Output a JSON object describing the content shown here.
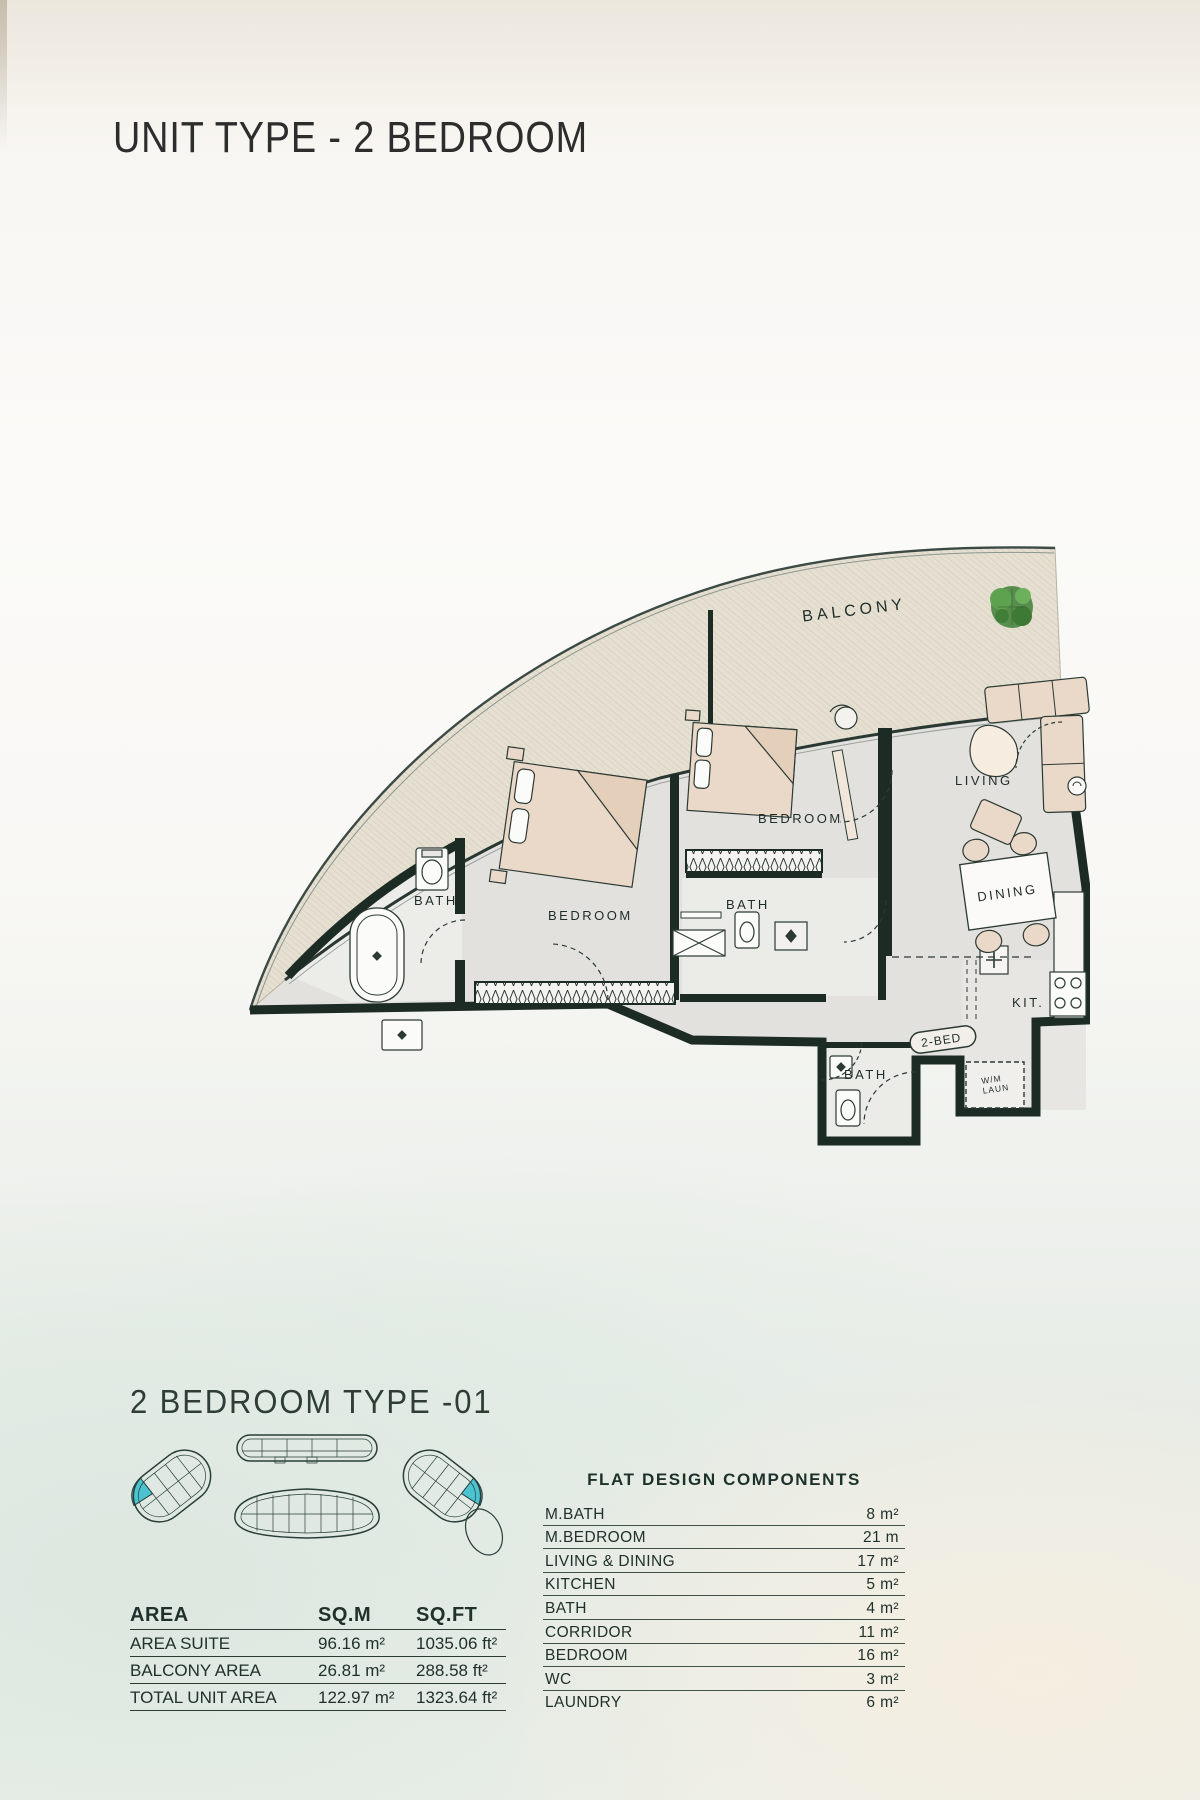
{
  "page": {
    "title": "UNIT TYPE - 2 BEDROOM",
    "section_title": "2 BEDROOM TYPE -01"
  },
  "floor_plan": {
    "labels": {
      "balcony": "BALCONY",
      "living": "LIVING",
      "dining": "DINING",
      "bedroom": "BEDROOM",
      "bath": "BATH",
      "kitchen": "KIT.",
      "unit_tag": "2-BED",
      "laundry_line1": "W/M",
      "laundry_line2": "LAUN"
    }
  },
  "area_table": {
    "headers": [
      "AREA",
      "SQ.M",
      "SQ.FT"
    ],
    "rows": [
      {
        "label": "AREA SUITE",
        "sqm": "96.16 m²",
        "sqft": "1035.06 ft²"
      },
      {
        "label": "BALCONY AREA",
        "sqm": "26.81 m²",
        "sqft": "288.58 ft²"
      },
      {
        "label": "TOTAL UNIT AREA",
        "sqm": "122.97 m²",
        "sqft": "1323.64 ft²"
      }
    ]
  },
  "components_table": {
    "title": "FLAT DESIGN COMPONENTS",
    "rows": [
      {
        "label": "M.BATH",
        "value": "8 m²"
      },
      {
        "label": "M.BEDROOM",
        "value": "21 m"
      },
      {
        "label": "LIVING & DINING",
        "value": "17 m²"
      },
      {
        "label": "KITCHEN",
        "value": "5 m²"
      },
      {
        "label": "BATH",
        "value": "4 m²"
      },
      {
        "label": "CORRIDOR",
        "value": "11 m²"
      },
      {
        "label": "BEDROOM",
        "value": "16 m²"
      },
      {
        "label": "WC",
        "value": "3 m²"
      },
      {
        "label": "LAUNDRY",
        "value": "6 m²"
      }
    ]
  },
  "colors": {
    "wall": "#1d2b25",
    "floor": "#e2e1dd",
    "balcony_fill": "#e6e0d2",
    "furniture": "#ead9c8",
    "tree_green": "#4b8742",
    "keyplan_highlight": "#4cc3d0",
    "text_dark": "#20312b"
  }
}
